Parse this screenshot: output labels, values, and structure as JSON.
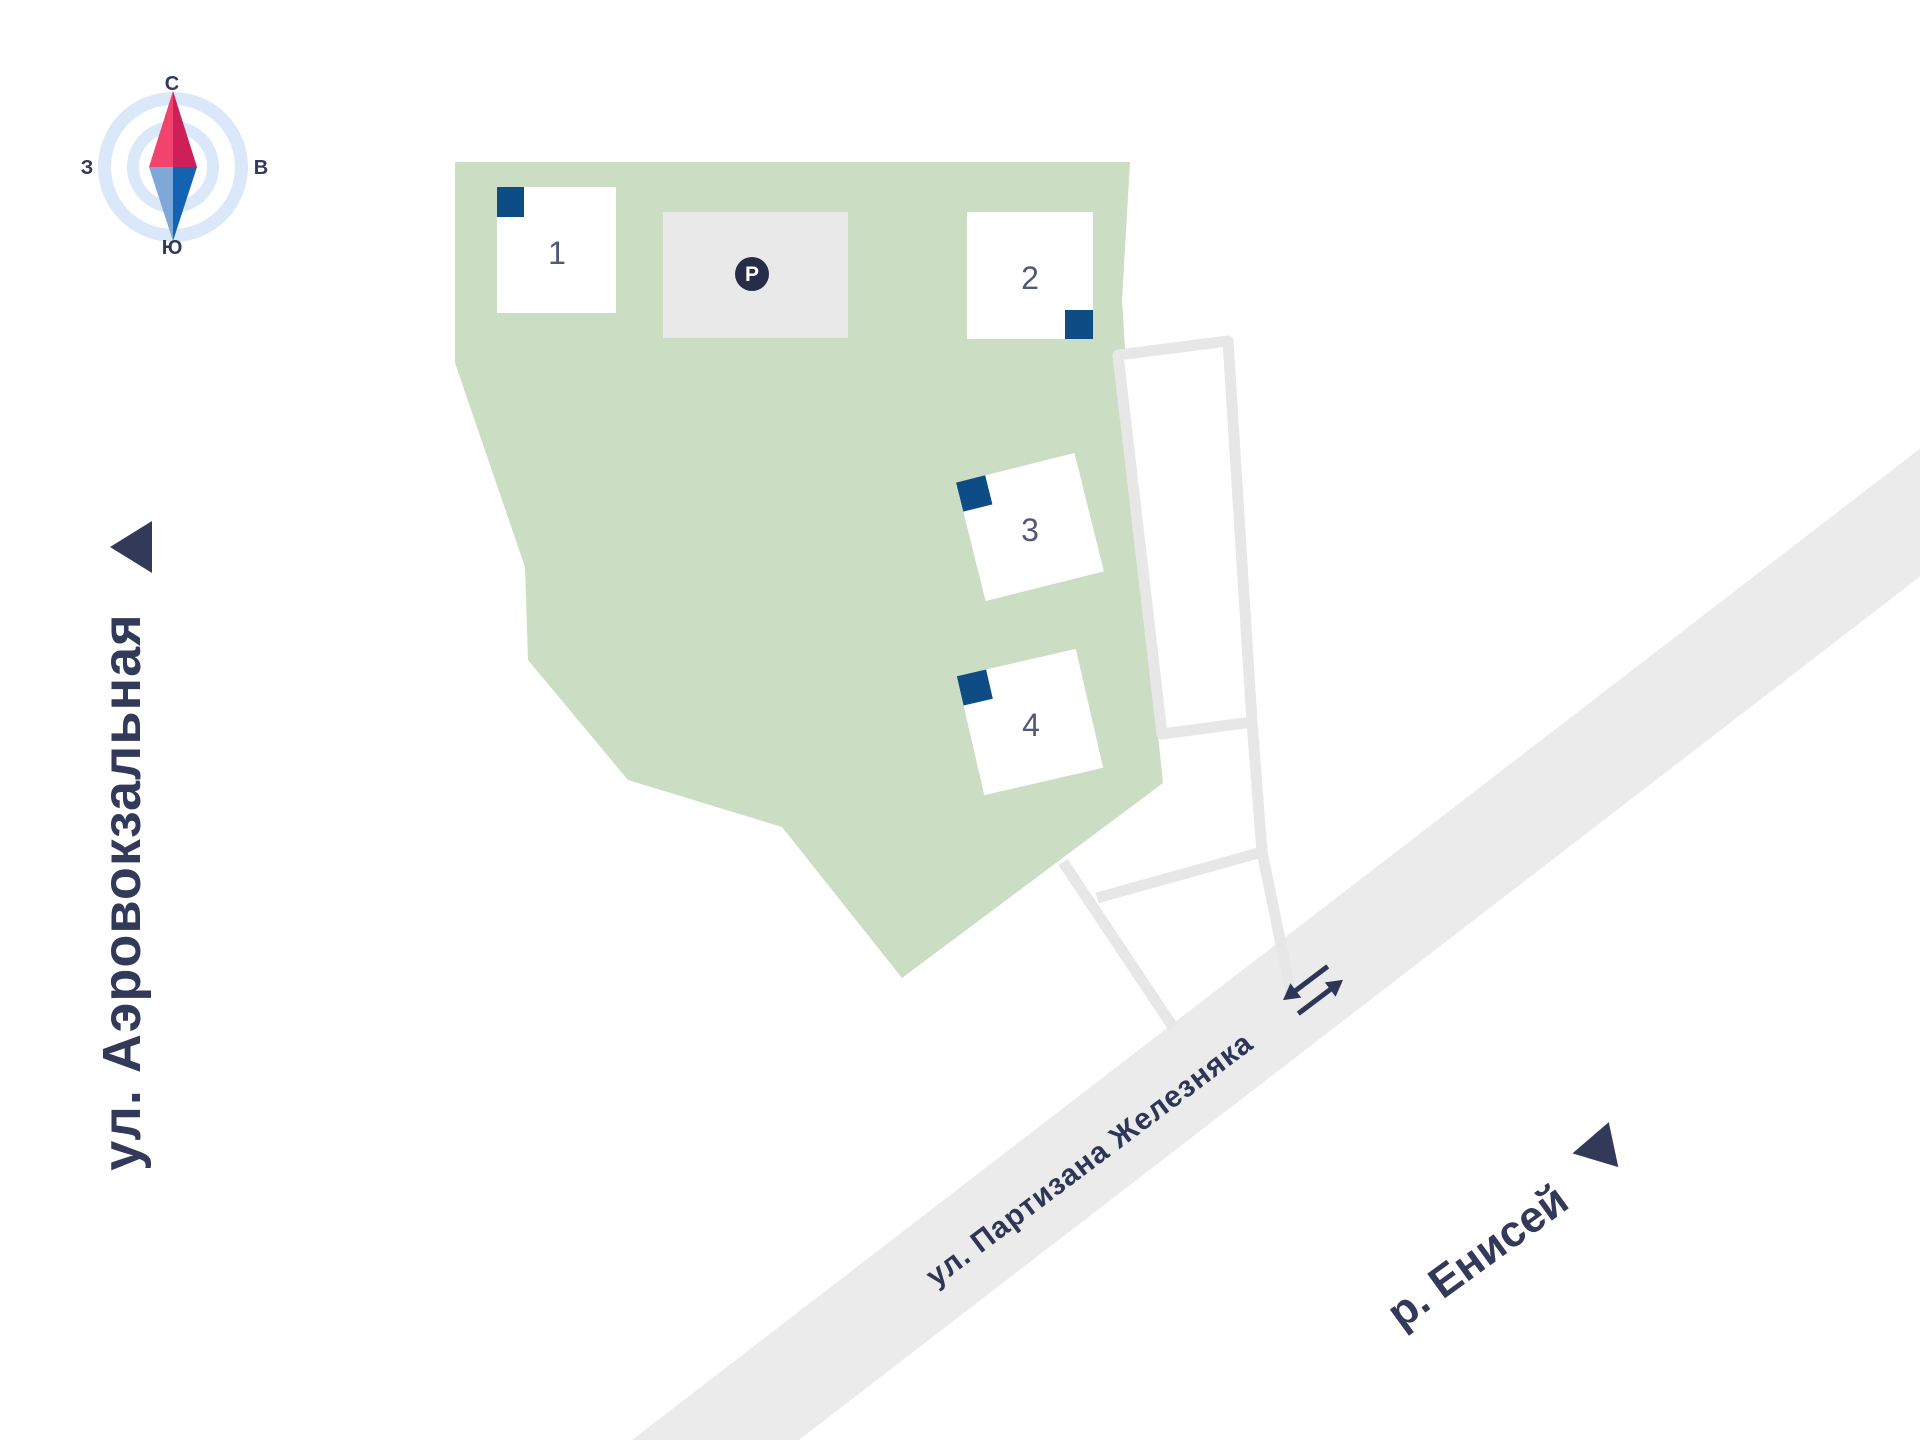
{
  "map": {
    "compass": {
      "north": "С",
      "east": "В",
      "south": "Ю",
      "west": "З"
    },
    "streets": {
      "left_street": "ул. Аэровокзальная",
      "main_road": "ул. Партизана Железняка",
      "river": "р. Енисей"
    },
    "site": {
      "buildings": [
        {
          "number": "1"
        },
        {
          "number": "2"
        },
        {
          "number": "3"
        },
        {
          "number": "4"
        }
      ],
      "parking_symbol": "P"
    },
    "colors": {
      "site_green": "#CBDEC3",
      "road_gray": "#EBEBEB",
      "parcel_outline_gray": "#E7E7E7",
      "parking_gray": "#E9E9E9",
      "building_marker_blue": "#0E4C85",
      "text_navy": "#333A59",
      "compass_ring_blue": "#DAE8F9",
      "needle_pink": "#F2436F",
      "needle_crimson": "#CE2058",
      "needle_light_blue": "#7EA8D8",
      "needle_blue": "#1463B3"
    }
  }
}
